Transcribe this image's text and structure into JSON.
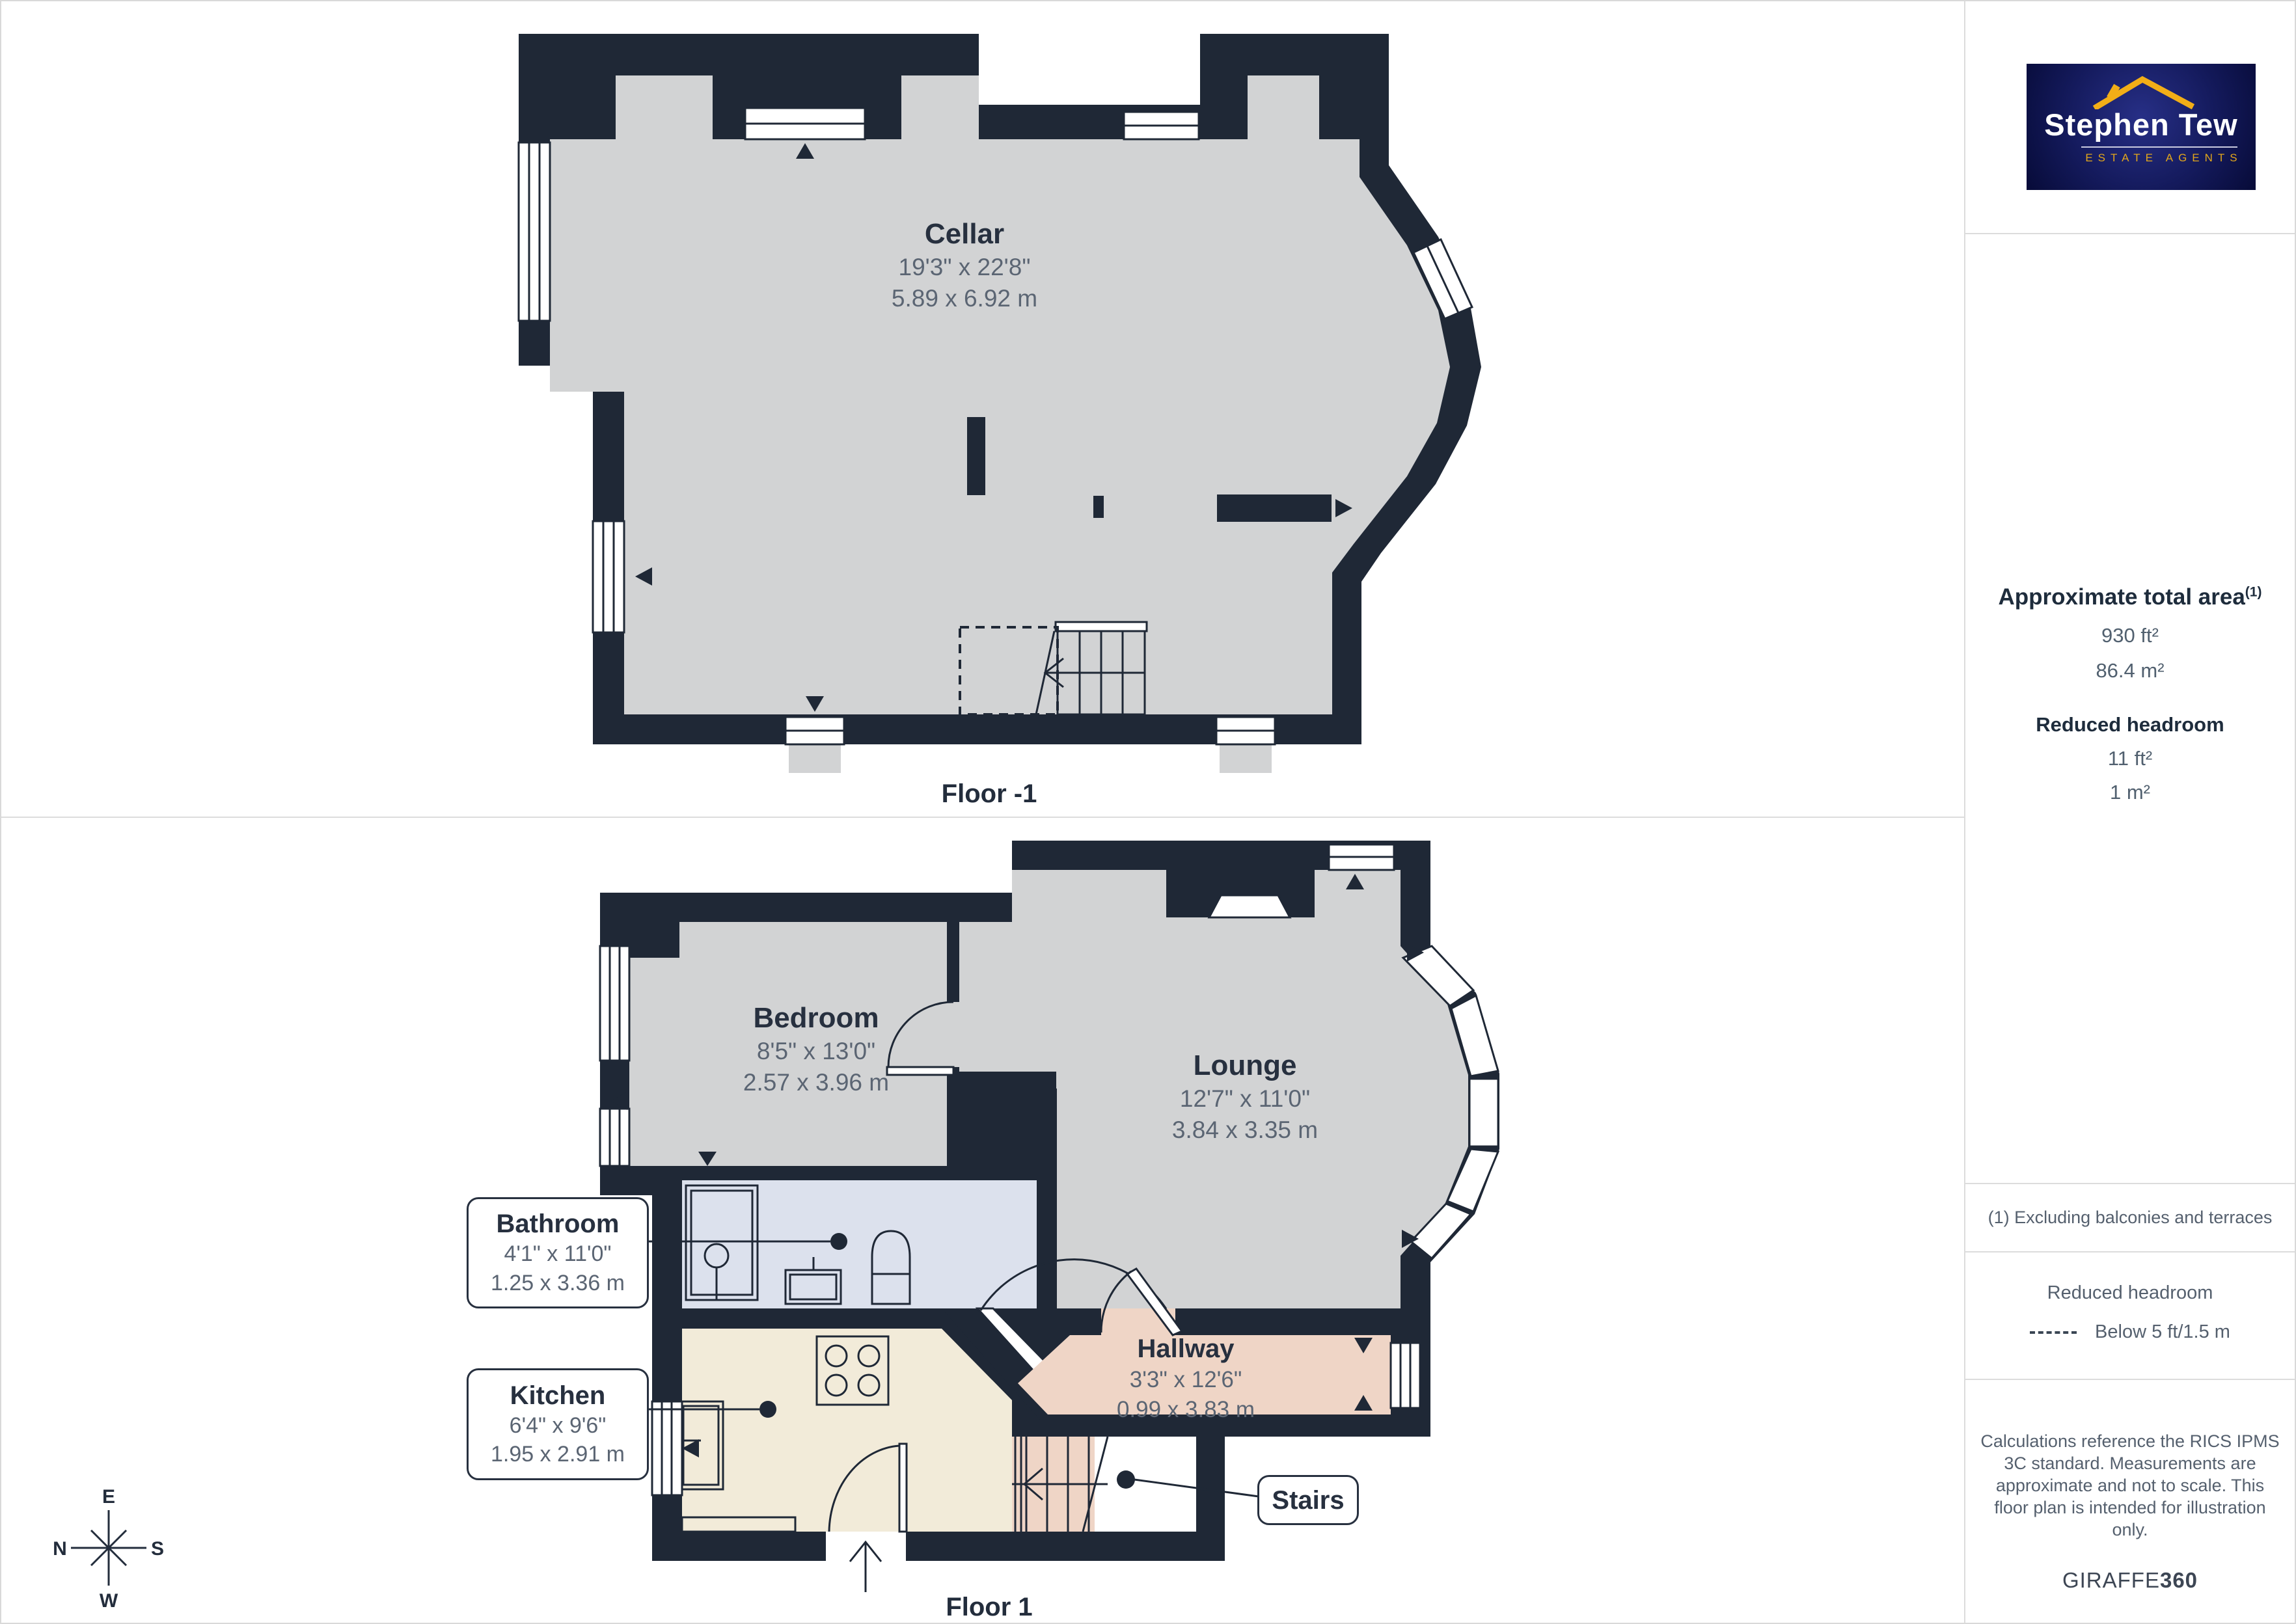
{
  "branding": {
    "agency_line1": "Stephen Tew",
    "agency_line2": "ESTATE AGENTS",
    "provider": "GIRAFFE",
    "provider_suffix": "360"
  },
  "sidebar": {
    "area_title": "Approximate total area",
    "area_title_sup": "(1)",
    "area_imperial": "930 ft²",
    "area_metric": "86.4 m²",
    "headroom_title": "Reduced headroom",
    "headroom_imperial": "11 ft²",
    "headroom_metric": "1 m²",
    "footnote": "(1) Excluding balconies and terraces",
    "legend_title": "Reduced headroom",
    "legend_item": "Below 5 ft/1.5 m",
    "disclaimer_lines": [
      "Calculations reference the RICS IPMS",
      "3C standard. Measurements are",
      "approximate and not to scale. This",
      "floor plan is intended for illustration",
      "only."
    ]
  },
  "floors": [
    {
      "caption": "Floor -1",
      "rooms": [
        {
          "name": "Cellar",
          "imperial": "19'3\" x 22'8\"",
          "metric": "5.89 x 6.92 m"
        }
      ]
    },
    {
      "caption": "Floor 1",
      "rooms": [
        {
          "name": "Bedroom",
          "imperial": "8'5\" x 13'0\"",
          "metric": "2.57 x 3.96 m"
        },
        {
          "name": "Lounge",
          "imperial": "12'7\" x 11'0\"",
          "metric": "3.84 x 3.35 m"
        },
        {
          "name": "Bathroom",
          "imperial": "4'1\" x 11'0\"",
          "metric": "1.25 x 3.36 m"
        },
        {
          "name": "Kitchen",
          "imperial": "6'4\" x 9'6\"",
          "metric": "1.95 x 2.91 m"
        },
        {
          "name": "Hallway",
          "imperial": "3'3\" x 12'6\"",
          "metric": "0.99 x 3.83 m"
        },
        {
          "name": "Stairs"
        }
      ]
    }
  ],
  "compass": {
    "top": "E",
    "left": "N",
    "right": "S",
    "bottom": "W"
  },
  "colors": {
    "wall": "#1f2836",
    "floor": "#d2d3d4",
    "bathroom": "#dce1ed",
    "kitchen": "#f2ebd9",
    "hallway": "#efd5c6",
    "logo_navy": "#10154f",
    "logo_gold": "#eda712"
  }
}
